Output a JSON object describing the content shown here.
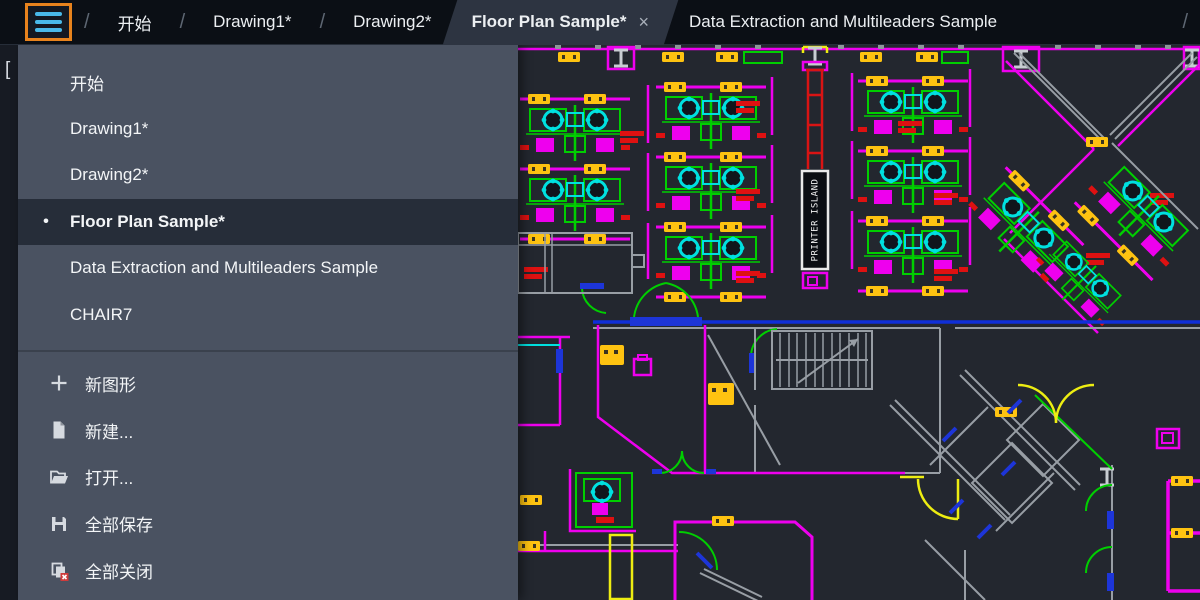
{
  "tab_bar": {
    "separator": "/",
    "trailing_separator": "/",
    "hamburger_icon": "hamburger-menu",
    "tabs": [
      {
        "label": "开始",
        "active": false
      },
      {
        "label": "Drawing1*",
        "active": false
      },
      {
        "label": "Drawing2*",
        "active": false
      },
      {
        "label": "Floor Plan Sample*",
        "active": true,
        "close_glyph": "×"
      },
      {
        "label": "Data Extraction and Multileaders Sample",
        "active": false
      }
    ]
  },
  "menu": {
    "active_bullet": "•",
    "files": [
      {
        "label": "开始"
      },
      {
        "label": "Drawing1*"
      },
      {
        "label": "Drawing2*"
      },
      {
        "label": "Floor Plan Sample*",
        "active": true
      },
      {
        "label": "Data Extraction and Multileaders Sample"
      },
      {
        "label": "CHAIR7"
      }
    ],
    "commands": [
      {
        "label": "新图形",
        "icon": "plus-icon"
      },
      {
        "label": "新建...",
        "icon": "new-file-icon"
      },
      {
        "label": "打开...",
        "icon": "open-folder-icon"
      },
      {
        "label": "全部保存",
        "icon": "save-all-icon"
      },
      {
        "label": "全部关闭",
        "icon": "close-all-icon"
      }
    ]
  },
  "canvas": {
    "left_bracket": "[",
    "printer_island_label": "PRINTER ISLAND",
    "colors": {
      "accent_orange": "#e8831d",
      "hamburger_bar": "#49b9e9",
      "tabbar_bg": "#0b0f15",
      "active_tab_bg": "#2d3441",
      "menu_bg": "#4a5261",
      "menu_active_bg": "#262d39",
      "canvas_bg": "#23272f",
      "wall_magenta": "#ee00ee",
      "desk_green": "#00cf00",
      "chair_cyan": "#00e0e0",
      "tag_yellow": "#fec311",
      "label_red": "#de1111",
      "door_blue": "#1d35d8",
      "wall_gray": "#989ea5",
      "column_red": "#d81414"
    }
  }
}
